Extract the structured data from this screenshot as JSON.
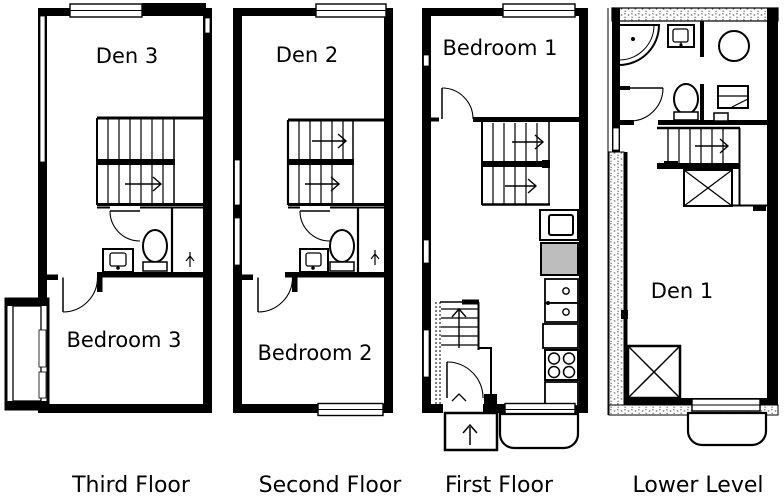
{
  "figure_type": "floor-plan-diagram",
  "colors": {
    "ink": "#000000",
    "paper": "#ffffff",
    "appliance_gray": "#bdbdbd",
    "hatch_gray": "#555555"
  },
  "floors": [
    {
      "id": "third-floor",
      "caption": "Third Floor",
      "rooms": [
        {
          "name": "den",
          "label": "Den 3"
        },
        {
          "name": "bedroom",
          "label": "Bedroom 3"
        }
      ]
    },
    {
      "id": "second-floor",
      "caption": "Second Floor",
      "rooms": [
        {
          "name": "den",
          "label": "Den 2"
        },
        {
          "name": "bedroom",
          "label": "Bedroom 2"
        }
      ]
    },
    {
      "id": "first-floor",
      "caption": "First Floor",
      "rooms": [
        {
          "name": "bedroom",
          "label": "Bedroom 1"
        }
      ]
    },
    {
      "id": "lower-level",
      "caption": "Lower Level",
      "rooms": [
        {
          "name": "den",
          "label": "Den 1"
        }
      ]
    }
  ],
  "icons": {
    "staircase": "parallel-tread-lines",
    "stair-direction-arrow": "line-with-chevron",
    "door-swing": "quarter-arc",
    "window": "double-line-gap",
    "balcony": "double-line-rail-box",
    "toilet-icon": "ellipse-with-tank",
    "sink-icon": "square-basin-with-faucet-dot",
    "shower-icon": "quarter-round-pan-with-drain",
    "shower-head-icon": "small-arrow-glyph",
    "washer-icon": "circle",
    "desk-icon": "rect-with-shelf-line",
    "refrigerator-icon": "gray-rect",
    "range-icon": "rect-with-4-burners",
    "laundry-stack-icon": "two-rects-with-knobs",
    "crawlspace-x-icon": "box-with-diagonals",
    "entry-stoop": "rect-with-up-arrow",
    "patio-stoop": "rounded-rect",
    "foundation-wall": "stipple-hatch-band"
  }
}
